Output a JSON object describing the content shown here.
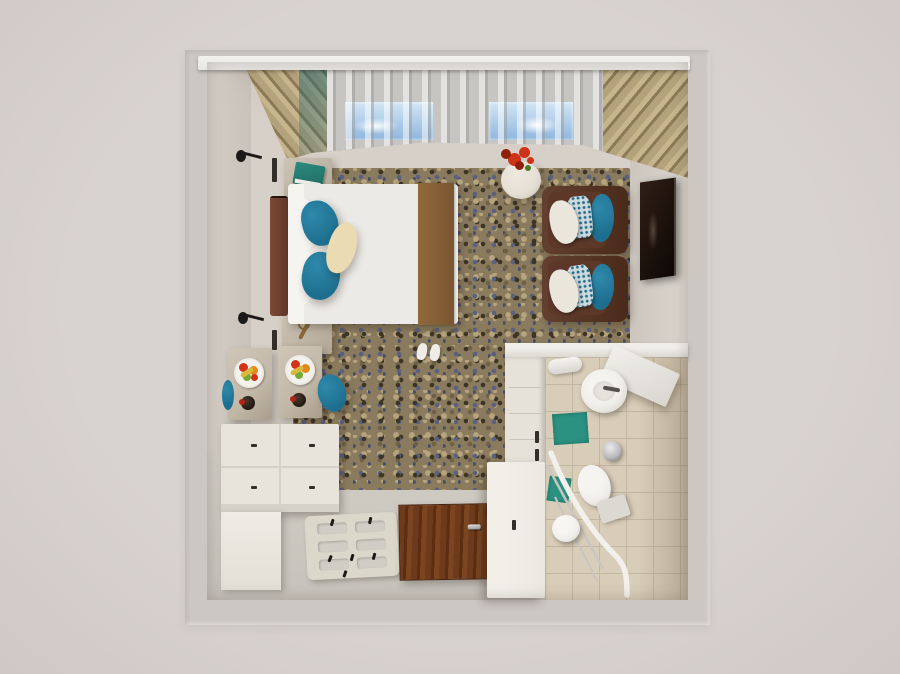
{
  "scene": {
    "kind": "3d-render-floorplan-top-view",
    "room": "hotel studio room with bedroom, entry zone and en-suite bathroom"
  },
  "objects": {
    "room_frame": "room outer wall frame",
    "window_wall": "window wall with sheer curtains and sky windows",
    "wood_slat_ceiling": "wood slat panels at window wall corners",
    "bed": "double bed with white duvet and brown runner",
    "headboard": "brown upholstered headboard",
    "nightstand_top": "nightstand with teal book",
    "nightstand_bottom": "nightstand with room key",
    "wall_lamp_top": "black wall sconce",
    "wall_lamp_bottom": "black wall sconce",
    "slippers": "pair of white slippers",
    "area_rug": "mottled blue-and-tan carpet",
    "side_table": "round marble side table",
    "flowers": "red poinsettia flowers",
    "armchair_1": "brown lounge chair with teal and patterned cushions",
    "armchair_2": "brown lounge chair with teal and patterned cushions",
    "tv": "wall-mounted flat TV",
    "dining_table_1": "marble table with fruit plate and wine bottle",
    "dining_table_2": "marble table with fruit plate and wine bottle",
    "dining_chair_right": "teal dining chair",
    "dining_chair_left": "teal dining chair",
    "sideboard": "white dresser sideboard with drawers",
    "luggage_rack": "folding luggage rack on floor",
    "entry_door": "wooden entry door with metal handle",
    "storage_bench": "white storage bench along bathroom wall",
    "closet": "white closet column",
    "bathroom": "en-suite bathroom with beige tile",
    "sink": "round washbasin with faucet",
    "vanity_counter": "angled vanity counter",
    "towel_roll": "rolled towel on holder",
    "bath_mat_sink": "teal bath mat",
    "bath_mat_shower": "teal shower mat",
    "trash_bin": "stainless trash bin",
    "toilet": "toilet with tank",
    "grab_rail": "curved white shower grab rail",
    "shower_stool": "round shower stool"
  },
  "colors": {
    "bg": "#d9d3cf",
    "bg_edge": "#cfc8c4",
    "frame": "#cdc7c3",
    "wall": "#d6d0c8",
    "wall_right": "#dad5cd",
    "wall_right_dk": "#ccc6be",
    "floor": "#d1cdc5",
    "pelmet": "#e9e7e3",
    "slat": "#b3a27c",
    "slat_dark": "#8b7a57",
    "slat_light": "#c6b58d",
    "curtain": "#c7c5c2",
    "sky_top": "#d3e6f5",
    "sky_bottom": "#8fb6dd",
    "carpet_base": "#8a7b5e",
    "carpet_dark": "#3c3526",
    "carpet_blue": "#5a6080",
    "carpet_blue2": "#474e68",
    "carpet_tan": "#b6a47d",
    "carpet_brown": "#6e6148",
    "bed_duvet": "#eceae6",
    "bed_sheet": "#f5f4f1",
    "bed_runner": "#90693c",
    "bed_runner_dk": "#7a5530",
    "headboard": "#7c4936",
    "headboard_dk": "#63372a",
    "pillow_teal": "#1e6f8f",
    "pillow_teal_hi": "#2e89aa",
    "pillow_cream": "#eadbb2",
    "nightstand": "#b2a795",
    "book_teal": "#2d8b80",
    "table_marble": "#c2b8a8",
    "sideboard": "#e8e4db",
    "sideboard_dk": "#d6d2c9",
    "rack": "#dbd7ca",
    "door_wood": "#6e3a1c",
    "door_wood_dark": "#5c2d12",
    "door_wood_hi": "#7b451f",
    "bench": "#ebe8e1",
    "closet": "#e6e2d9",
    "bath_tile": "#d8cdb8",
    "bath_grout": "#c2b7a1",
    "bath_wall": "#d9d4cd",
    "teal_mat": "#2b9181",
    "porcelain": "#f0eeea",
    "porcelain_dk": "#dcd9d3",
    "steel": "#b9b9bb",
    "chair_brown": "#63402f",
    "chair_brown_dk": "#4a2a1a",
    "chair_seat": "#5d3829",
    "tv": "#1d120c",
    "table_round": "#e6e0d6",
    "flower_red": "#cc3318",
    "flower_dark": "#8e1f0b",
    "flower_green": "#4a7a28",
    "fruit_red": "#d23217",
    "fruit_orange": "#e08a1e",
    "fruit_green": "#76a832",
    "fruit_banana": "#d8b93c",
    "wine": "#241a14",
    "wine_cap": "#b02418",
    "sconce": "#1c1a18",
    "slipper": "#efece6"
  }
}
